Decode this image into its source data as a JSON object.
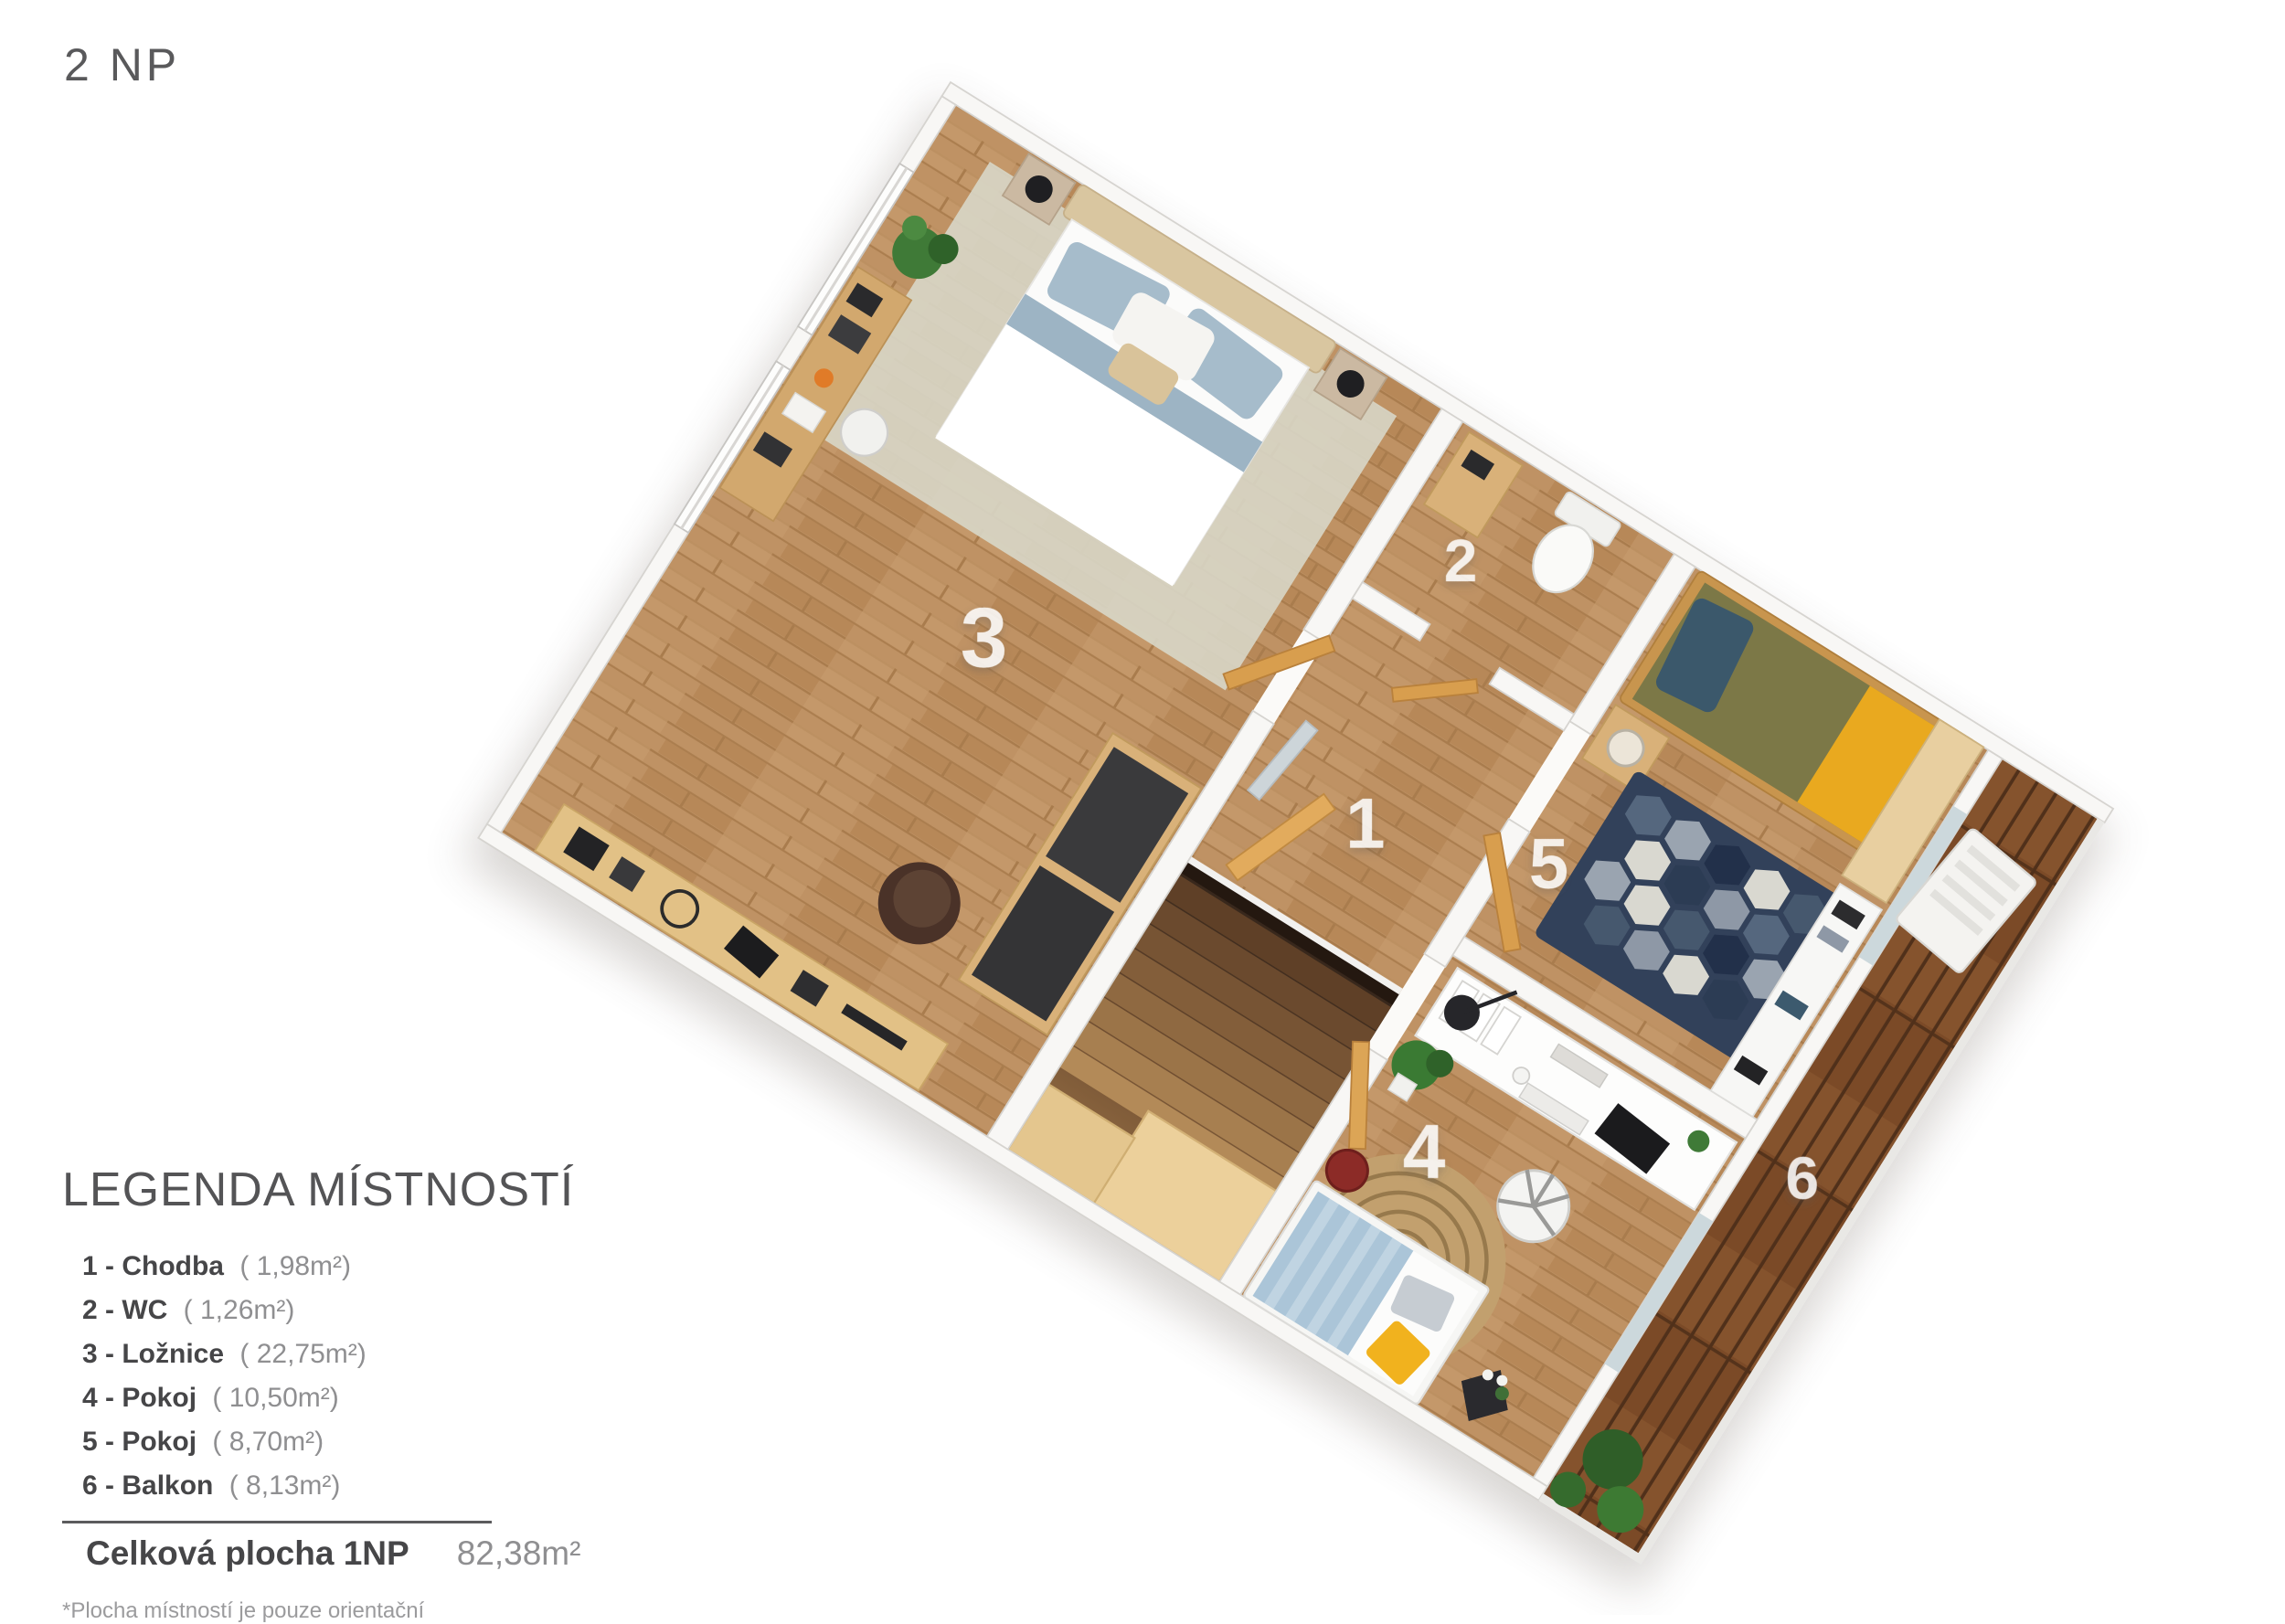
{
  "page": {
    "floor_label": "2 NP"
  },
  "legend": {
    "title": "LEGENDA MÍSTNOSTÍ",
    "items": [
      {
        "label": "1 - Chodba",
        "area": "( 1,98m²)"
      },
      {
        "label": "2 - WC",
        "area": "( 1,26m²)"
      },
      {
        "label": "3 - Ložnice",
        "area": "( 22,75m²)"
      },
      {
        "label": "4 - Pokoj",
        "area": "( 10,50m²)"
      },
      {
        "label": "5 - Pokoj",
        "area": "( 8,70m²)"
      },
      {
        "label": "6 - Balkon",
        "area": "( 8,13m²)"
      }
    ],
    "total_label": "Celková plocha 1NP",
    "total_value": "82,38m²",
    "footnote": "*Plocha místností je pouze orientační"
  },
  "floor_plan": {
    "rooms": [
      {
        "number": "1",
        "name": "Chodba"
      },
      {
        "number": "2",
        "name": "WC"
      },
      {
        "number": "3",
        "name": "Ložnice"
      },
      {
        "number": "4",
        "name": "Pokoj"
      },
      {
        "number": "5",
        "name": "Pokoj"
      },
      {
        "number": "6",
        "name": "Balkon"
      }
    ],
    "colors": {
      "floor_wood": "#bf9264",
      "balcony_deck": "#7b4a27",
      "wall": "#f8f7f5",
      "door_wood": "#d89e4e",
      "room_label": "rgba(255,255,255,0.85)",
      "bed5_olive": "#7c7847",
      "bed5_mustard": "#e9a91f",
      "bed4_blue": "#abc5d8",
      "rug5_navy": "#32415a",
      "rug4_jute": "#c2a06e"
    }
  }
}
